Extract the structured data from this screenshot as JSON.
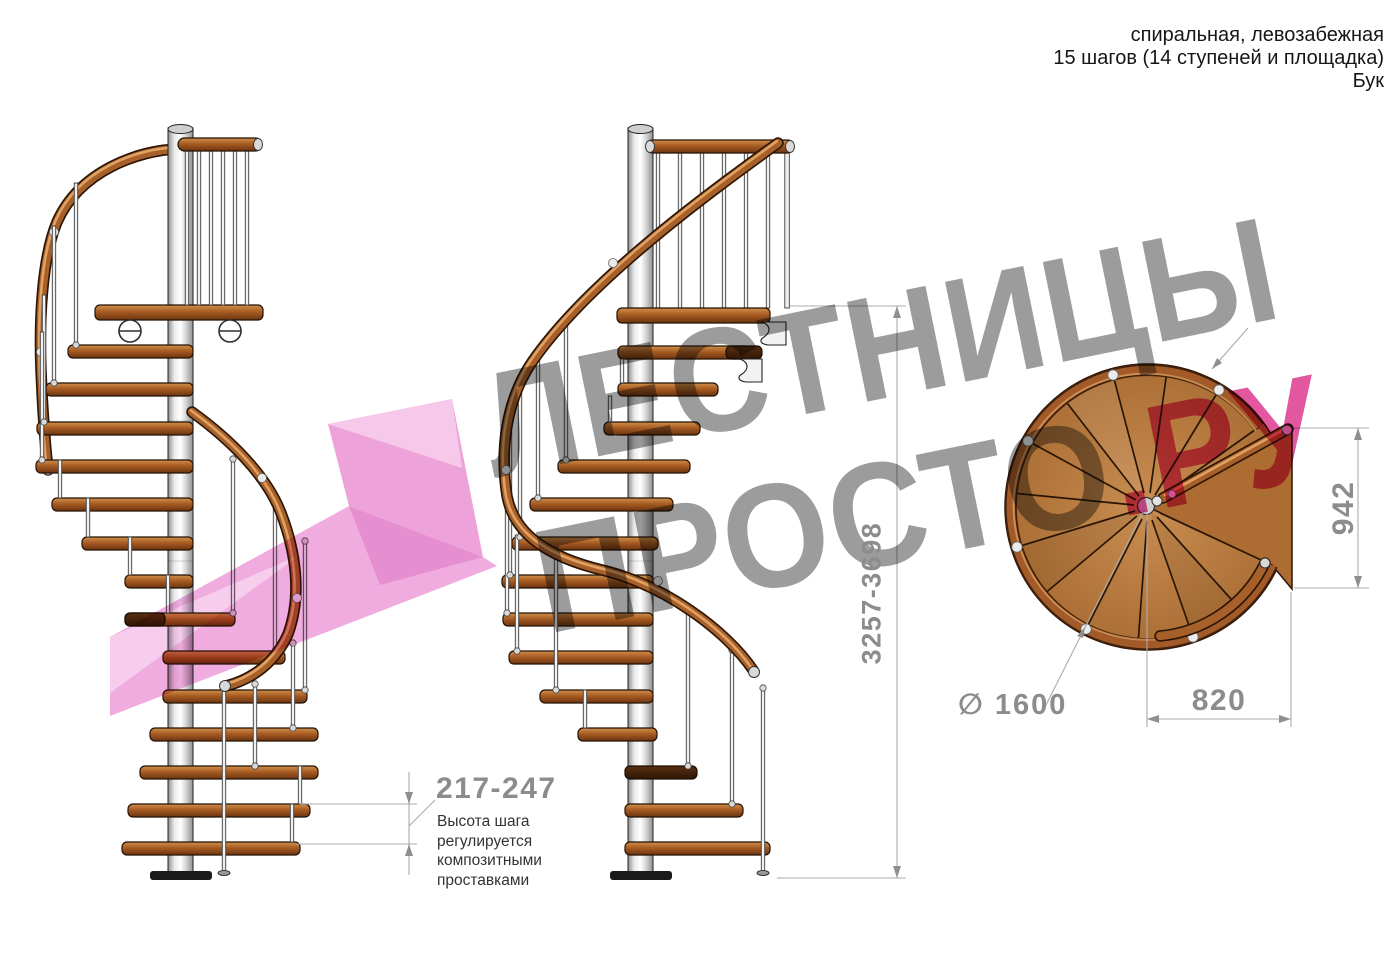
{
  "header": {
    "line1": "спиральная, левозабежная",
    "line2": "15 шагов (14 ступеней и площадка)",
    "line3": "Бук"
  },
  "dimensions": {
    "step_height": "217-247",
    "step_height_note": "Высота шага\nрегулируется\nкомпозитными\nпроставками",
    "total_height": "3257-3698",
    "platform_width": "942",
    "platform_depth": "820",
    "diameter": "∅ 1600"
  },
  "watermark": {
    "line1": "ЛЕСТНИЦЫ",
    "line2_gray": "ПРОСТО",
    "line2_pink": ".РУ"
  },
  "colors": {
    "watermark_gray": "#9c9c9c",
    "watermark_pink": "#e2579f",
    "logo_pink": "#f0acdf",
    "wood": "#b5763c",
    "wood_dark": "#8a4a22",
    "metal_light": "#ececec",
    "dimension_gray": "#8c8c8c",
    "note_text": "#333333"
  }
}
